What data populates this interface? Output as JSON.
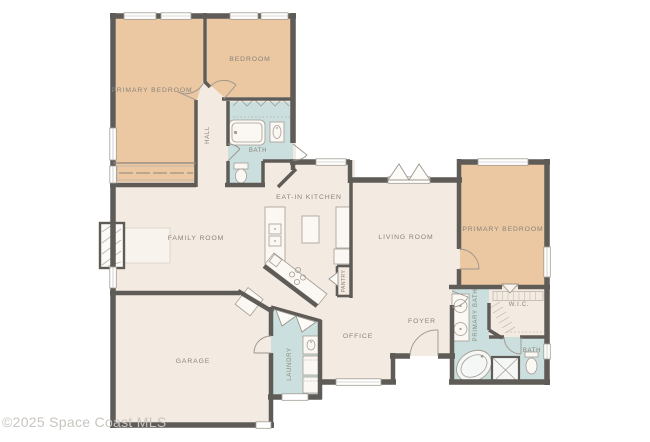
{
  "watermark": "©2025 Space Coast MLS",
  "colors": {
    "background": "#ffffff",
    "wall": "#5f5c58",
    "floor": "#f3eae1",
    "bedroom": "#ebc7a2",
    "wet_room": "#cbdfde",
    "fixture": "#fbf8f3",
    "window": "#ffffff",
    "label": "#8a857b",
    "watermark_text": "#c9c5c0"
  },
  "rooms": {
    "primary_bedroom_left": "PRIMARY BEDROOM",
    "bedroom": "BEDROOM",
    "hall": "HALL",
    "bath": "BATH",
    "family_room": "FAMILY ROOM",
    "eat_in_kitchen": "EAT-IN KITCHEN",
    "pantry": "PANTRY",
    "living_room": "LIVING ROOM",
    "primary_bedroom_right": "PRIMARY BEDROOM",
    "wic": "W.I.C.",
    "primary_bath": "PRIMARY BATH",
    "bath_2": "BATH",
    "foyer": "FOYER",
    "office": "OFFICE",
    "laundry": "LAUNDRY",
    "garage": "GARAGE"
  }
}
